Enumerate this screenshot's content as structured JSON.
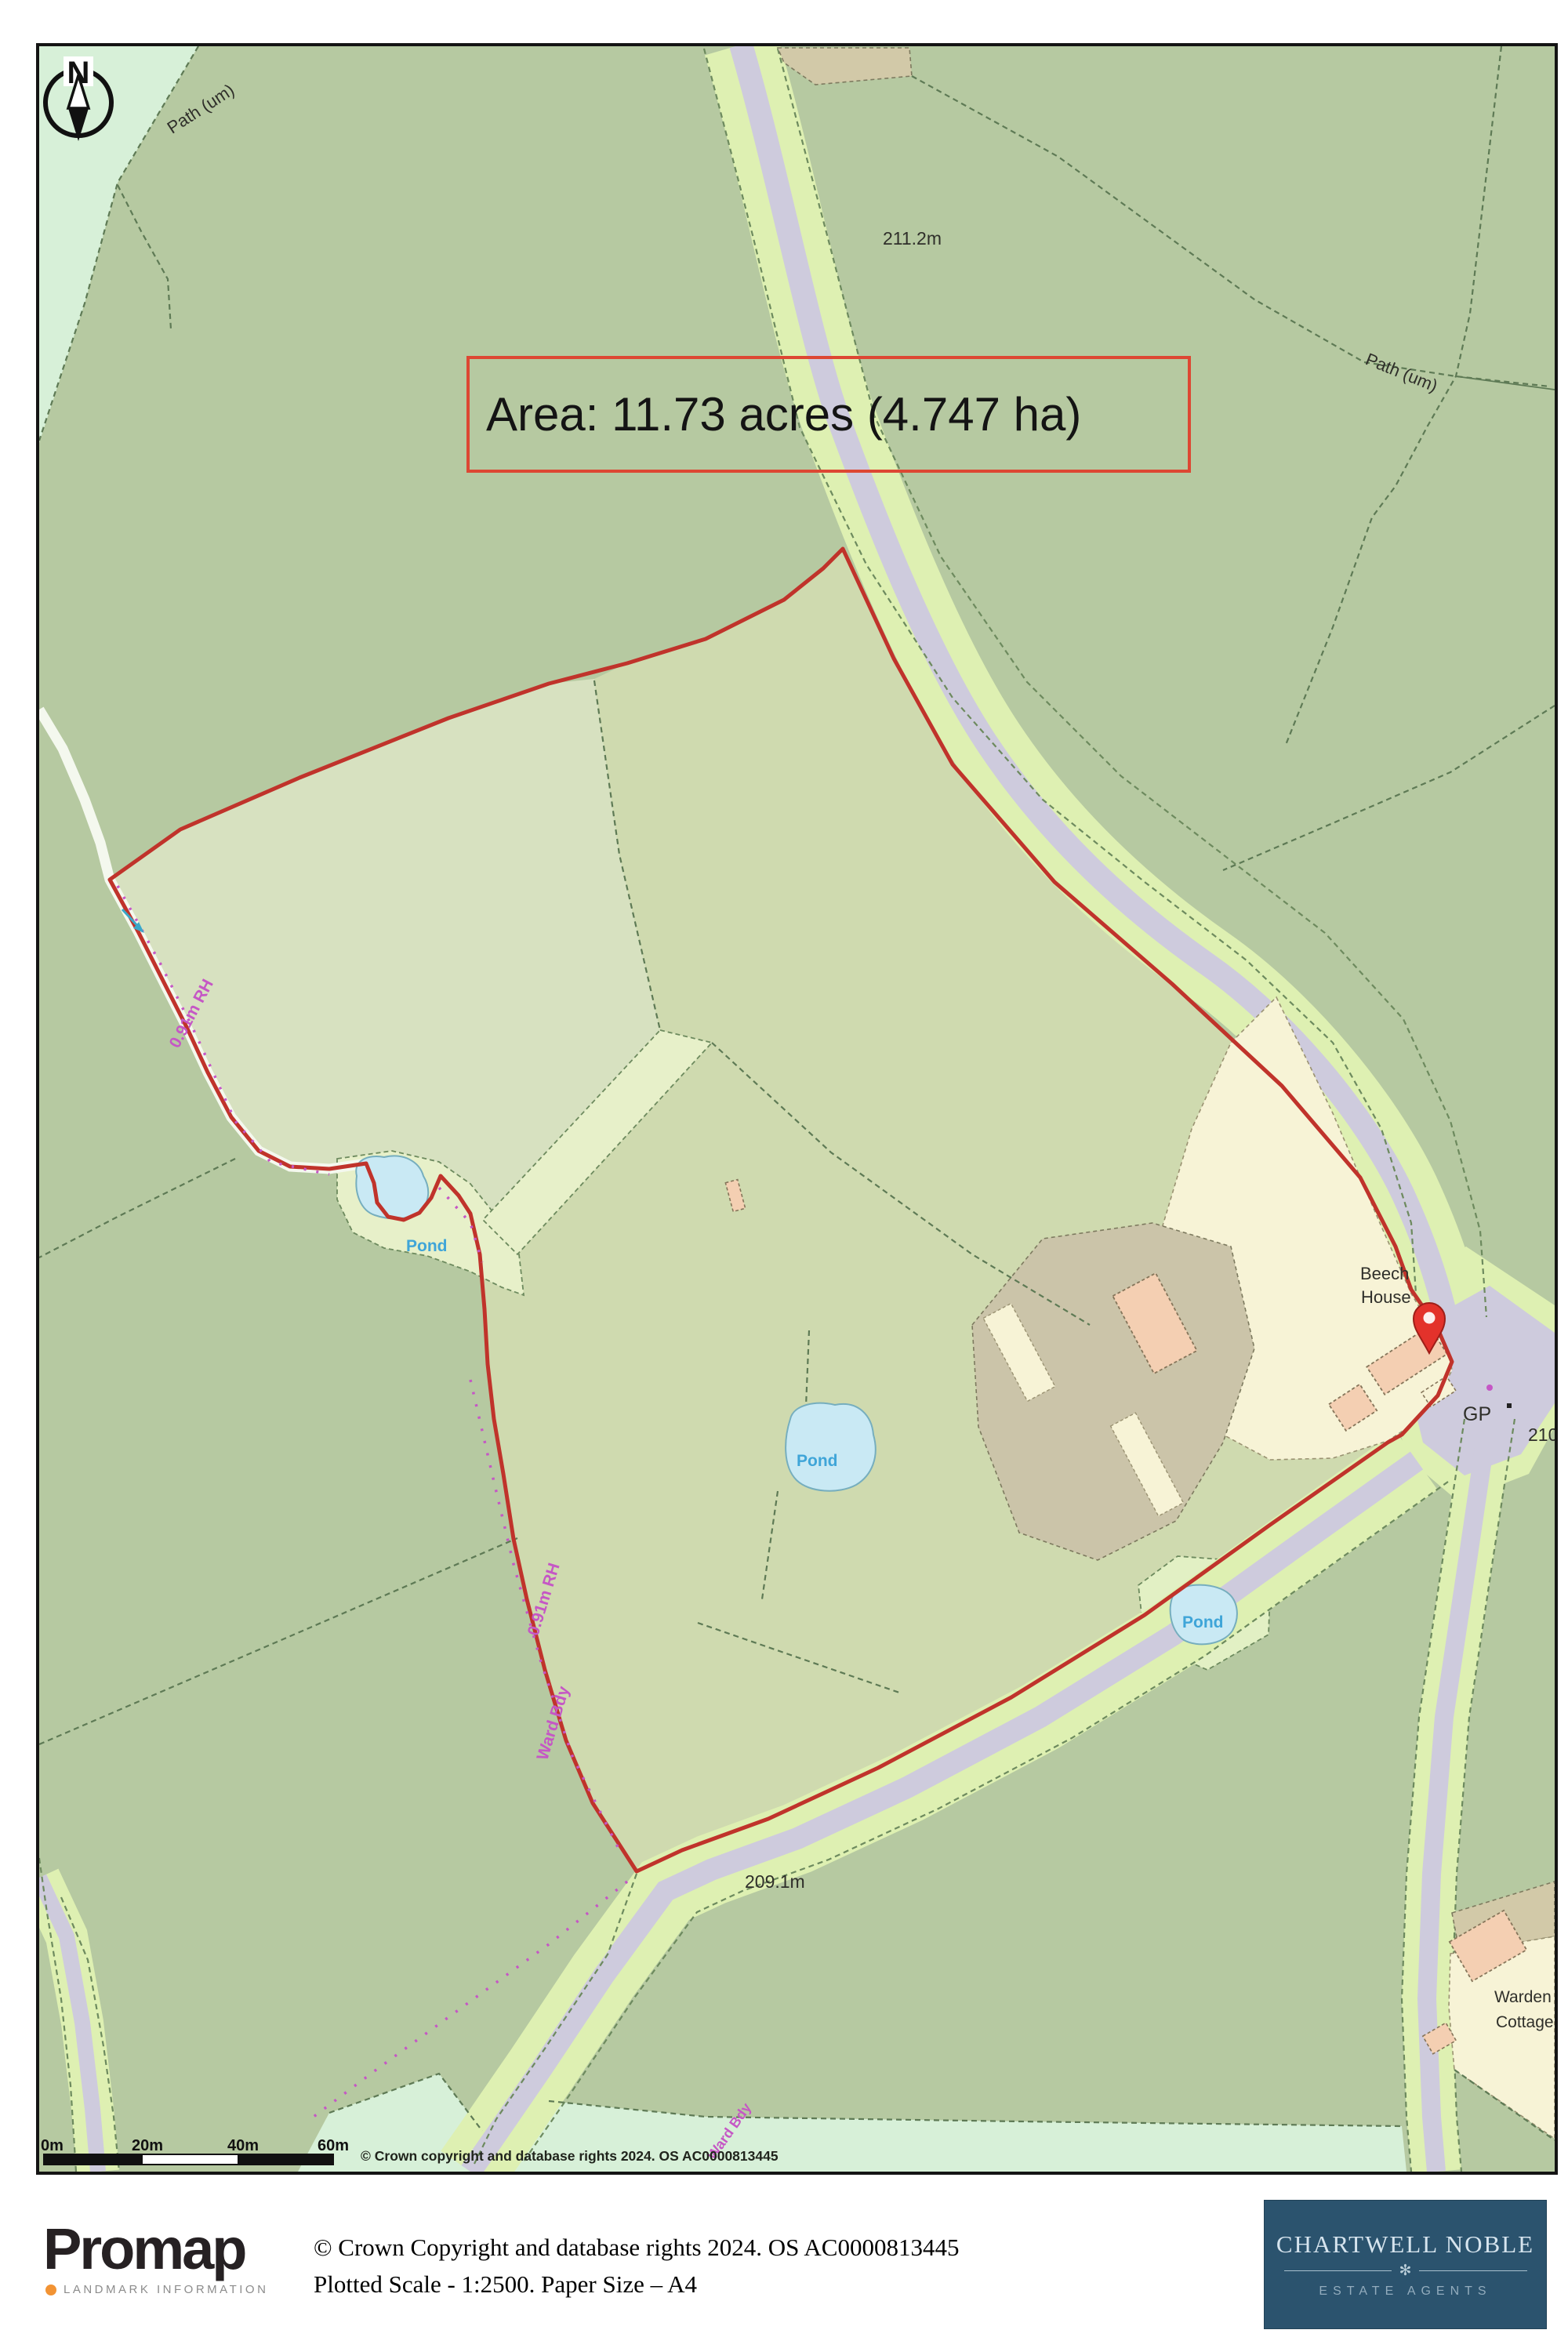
{
  "map": {
    "area_box": {
      "label": "Area: 11.73 acres (4.747 ha)"
    },
    "compass": {
      "north": "N"
    },
    "labels": {
      "path_nw": "Path (um)",
      "path_ne": "Path (um)",
      "spot_211": "211.2m",
      "spot_209": "209.1m",
      "spot_210": "210",
      "gp": "GP",
      "beech_1": "Beech",
      "beech_2": "House",
      "warden_1": "Warden",
      "warden_2": "Cottage",
      "pond": "Pond",
      "rh_upper": "0.91m RH",
      "rh_lower": "0.91m RH",
      "ward_bdy": "Ward Bdy",
      "ward_bdy_road": "Ward Bdy"
    },
    "scale_bar": {
      "t0": "0m",
      "t1": "20m",
      "t2": "40m",
      "t3": "60m"
    },
    "copyright": "© Crown copyright and database rights 2024. OS AC0000813445"
  },
  "footer": {
    "promap": "Promap",
    "landmark": "LANDMARK INFORMATION",
    "line1": "© Crown Copyright and database rights 2024. OS AC0000813445",
    "line2": "Plotted Scale - 1:2500. Paper Size – A4",
    "agent": {
      "name": "CHARTWELL NOBLE",
      "subtitle": "ESTATE AGENTS",
      "ornament": "✻"
    }
  },
  "colors": {
    "boundary_red": "#c0332b",
    "area_box_border": "#dd4733",
    "field_outside": "#b6c9a1",
    "field_inside_nw": "#d7e1c0",
    "field_inside_mid": "#cfdaaf",
    "mint": "#d7f0d8",
    "pale_scrub": "#e7f0c9",
    "road_grey": "#cecbdd",
    "road_verge": "#def0b2",
    "tan": "#cbc4a9",
    "cream": "#f7f3d6",
    "building_salmon": "#f4cfb2",
    "pond_blue": "#c9e9f4",
    "pond_text": "#3fa5d8",
    "magenta": "#c557c5",
    "agent_navy": "#2b536e",
    "landmark_orange": "#f29334"
  }
}
